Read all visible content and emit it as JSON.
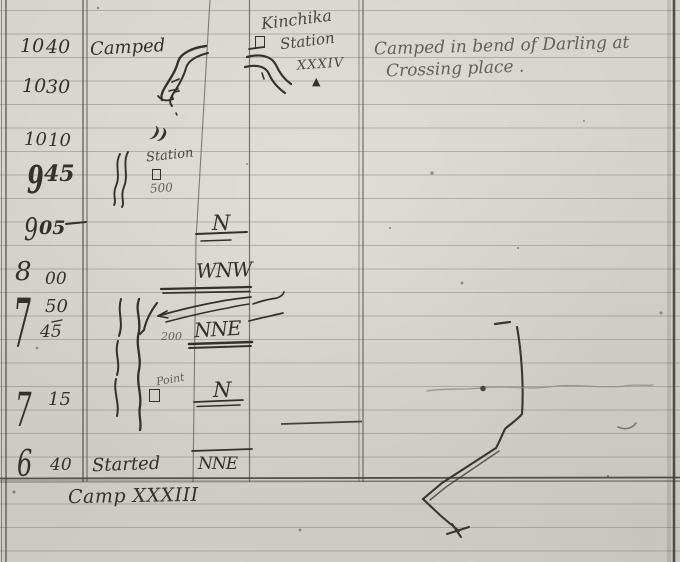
{
  "colors": {
    "paper": "#d7d4ce",
    "ink": "#35312a",
    "pencil": "#665f54",
    "pencil_dark": "#4c473e",
    "rule": "#aaa59c",
    "line": "#4e4a42"
  },
  "note": {
    "line1": "Camped in bend of Darling at",
    "line2": "Crossing place ."
  },
  "station_marker": {
    "name": "Kinchika",
    "type_label": "Station",
    "numeral": "XXXIV",
    "flag_symbol": "▲"
  },
  "log": {
    "rows": [
      {
        "hour": "10",
        "minute": "40",
        "remark": "Camped",
        "bearing": ""
      },
      {
        "hour": "10",
        "minute": "30",
        "remark": "",
        "bearing": ""
      },
      {
        "hour": "10",
        "minute": "10",
        "remark": "",
        "bearing": ""
      },
      {
        "hour": "9",
        "minute": "45",
        "remark": "Station",
        "distance": "500",
        "bearing": ""
      },
      {
        "hour": "9",
        "minute": "05",
        "remark": "",
        "bearing": "N"
      },
      {
        "hour": "8",
        "minute": "00",
        "remark": "",
        "bearing": "WNW"
      },
      {
        "hour": "7",
        "minute": "50",
        "remark": "",
        "bearing": ""
      },
      {
        "hour": "",
        "minute": "45",
        "remark": "",
        "distance": "200",
        "bearing": "NNE"
      },
      {
        "hour": "7",
        "minute": "15",
        "remark": "Point",
        "bearing": "N"
      },
      {
        "hour": "6",
        "minute": "40",
        "remark": "Started",
        "bearing": "NNE"
      }
    ]
  },
  "annotations": {
    "double_paren": "))",
    "camp_label": "Camp XXXIII"
  }
}
